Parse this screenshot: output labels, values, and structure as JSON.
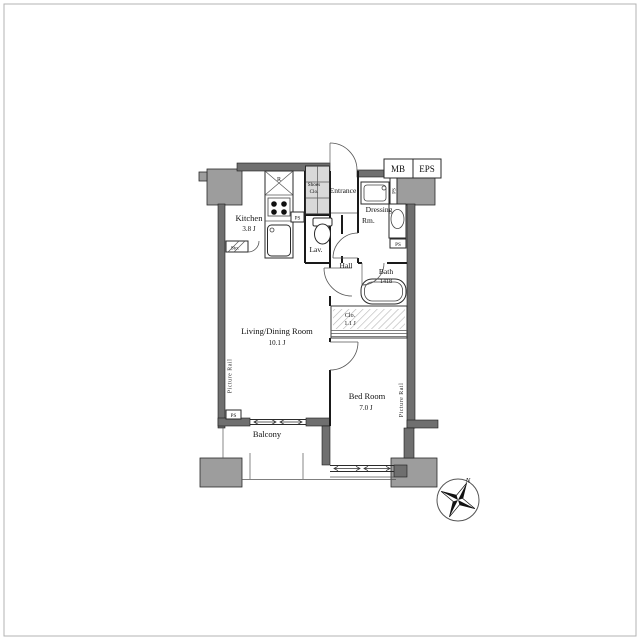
{
  "colors": {
    "wall": "#6f6f6f",
    "pillar": "#9d9d9d",
    "line": "#1a1a1a",
    "closet_shade": "#d9d9d9",
    "background": "#ffffff"
  },
  "rooms": {
    "kitchen": {
      "name": "Kitchen",
      "size": "3.8 J"
    },
    "living_dining": {
      "name": "Living/Dining Room",
      "size": "10.1 J"
    },
    "bed_room": {
      "name": "Bed Room",
      "size": "7.0 J"
    },
    "balcony": {
      "name": "Balcony"
    },
    "hall": {
      "name": "Hall"
    },
    "lavatory": {
      "name": "Lav."
    },
    "bath": {
      "name": "Bath",
      "size": "1418"
    },
    "entrance": {
      "name": "Entrance"
    },
    "dressing_room": {
      "name_line1": "Dressing",
      "name_line2": "Rm."
    },
    "shoes_closet": {
      "name_line1": "Shoes",
      "name_line2": "Clo."
    },
    "closet": {
      "name": "Clo.",
      "size": "1.1 J"
    }
  },
  "labels": {
    "meter_box": "MB",
    "eps": "EPS",
    "pipe_space": "PS",
    "storage": "Sto.",
    "refrigerator": "R",
    "picture_rail": "Picture Rail",
    "north": "N"
  }
}
